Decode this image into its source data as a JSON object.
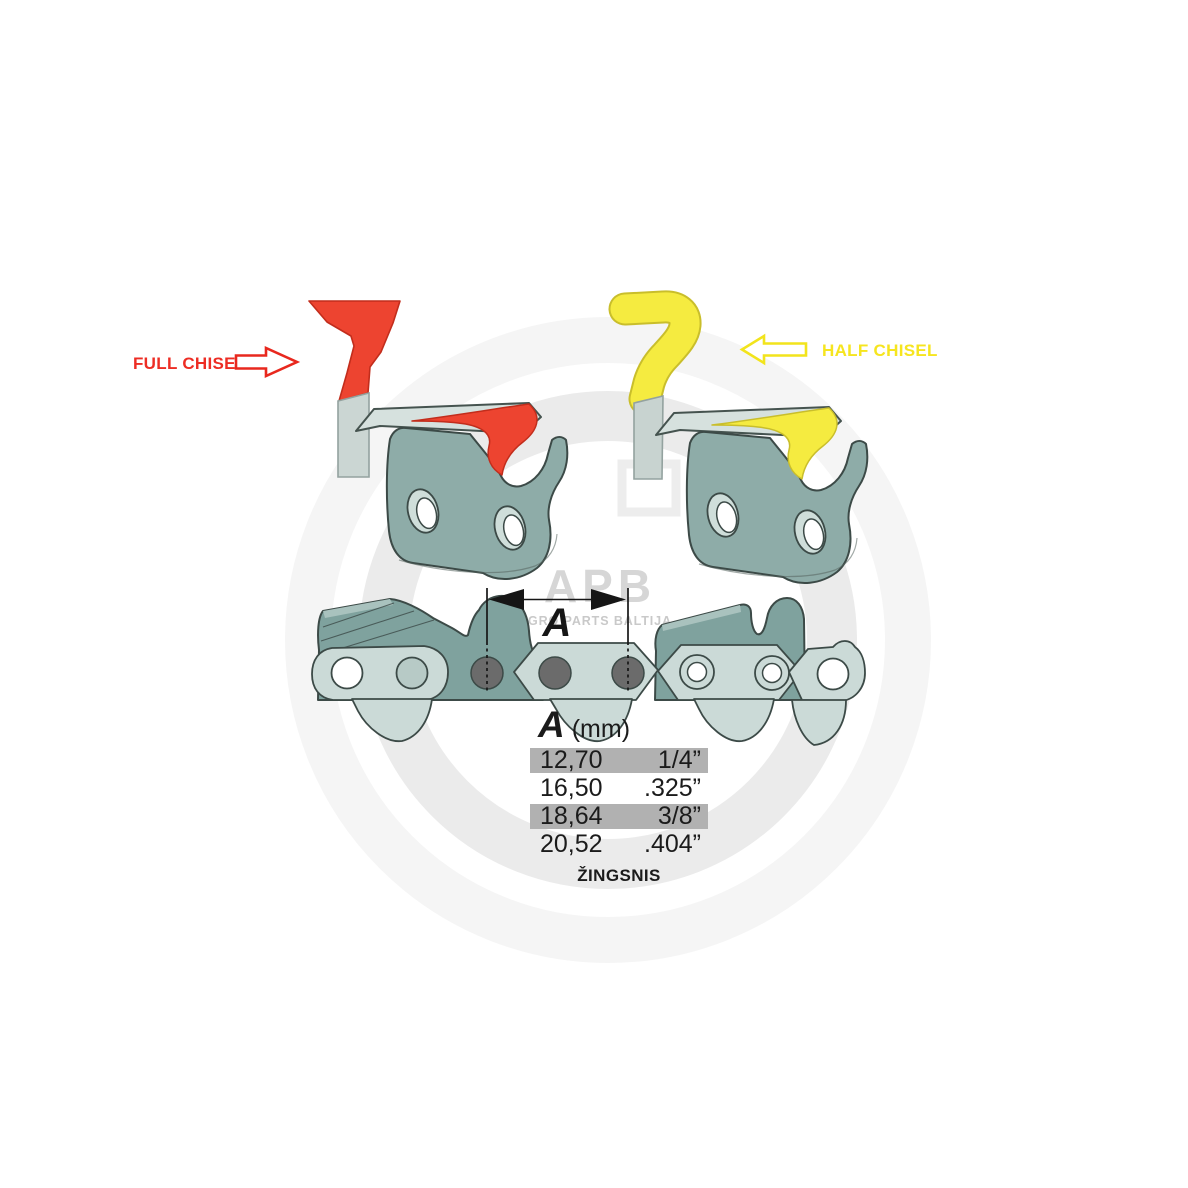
{
  "watermark": {
    "logo_text": "APB",
    "subtitle": "AGRO PARTS BALTIJA"
  },
  "cutters": {
    "full": {
      "label": "FULL CHISEL",
      "color": "#ED4430",
      "label_color": "#ED2D24",
      "arrow_direction": "right"
    },
    "half": {
      "label": "HALF CHISEL",
      "color": "#F5EB40",
      "label_color": "#F6E51F",
      "arrow_direction": "left"
    }
  },
  "dimension": {
    "letter": "A"
  },
  "pitch_table": {
    "header_letter": "A",
    "header_unit": "(mm)",
    "rows": [
      {
        "mm": "12,70",
        "inch": "1/4”",
        "highlighted": true
      },
      {
        "mm": "16,50",
        "inch": ".325”",
        "highlighted": false
      },
      {
        "mm": "18,64",
        "inch": "3/8”",
        "highlighted": true
      },
      {
        "mm": "20,52",
        "inch": ".404”",
        "highlighted": false
      }
    ],
    "caption": "ŽINGSNIS"
  },
  "colors": {
    "full_chisel_red": "#ED4430",
    "half_chisel_yellow": "#F5EB40",
    "link_body_teal": "#8EACA8",
    "cutter_teal": "#7FA29E",
    "plate_light": "#CBDAD7",
    "rivet_gray": "#6B6B6B",
    "row_highlight_gray": "#B1B1B1",
    "watermark_gray": "#D6D6D6"
  }
}
